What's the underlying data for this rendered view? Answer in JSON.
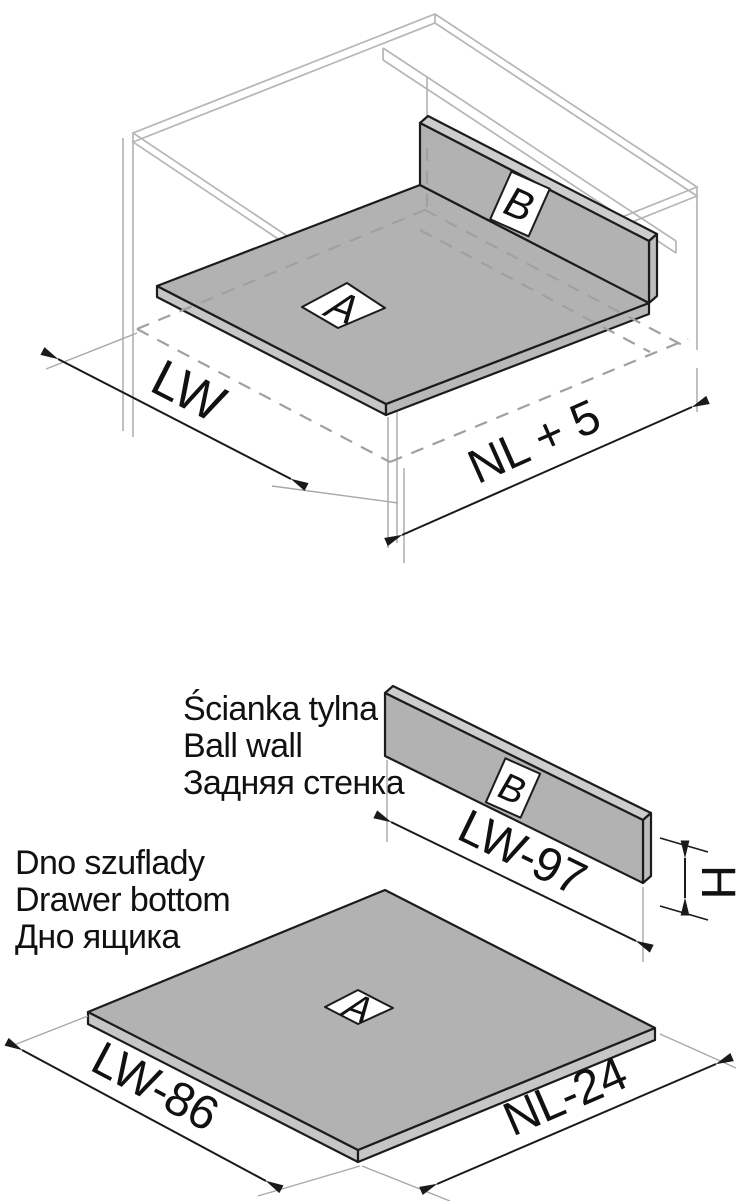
{
  "document_title": "Drawer assembly dimensioning diagram",
  "colors": {
    "background": "#ffffff",
    "panel_gray": "#b2b2b2",
    "panel_edge_light": "#c6c6c6",
    "panel_top_strip": "#cdcdcd",
    "cabinet_line_gray": "#b6b6b6",
    "hidden_line_gray": "#a0a0a0",
    "outline_black": "#1a1a1a"
  },
  "assembly_view": {
    "part_a_label": "A",
    "part_b_label": "B",
    "dim_cabinet_width": "LW",
    "dim_runner_length": "NL + 5"
  },
  "parts_view": {
    "back_wall": {
      "caption_pl": "Ścianka tylna",
      "caption_en": "Ball wall",
      "caption_ru": "Задняя стенка",
      "part_label": "B",
      "dim_length": "LW-97",
      "dim_height": "H"
    },
    "drawer_bottom": {
      "caption_pl": "Dno szuflady",
      "caption_en": "Drawer bottom",
      "caption_ru": "Дно ящика",
      "part_label": "A",
      "dim_width": "LW-86",
      "dim_depth": "NL-24"
    }
  }
}
